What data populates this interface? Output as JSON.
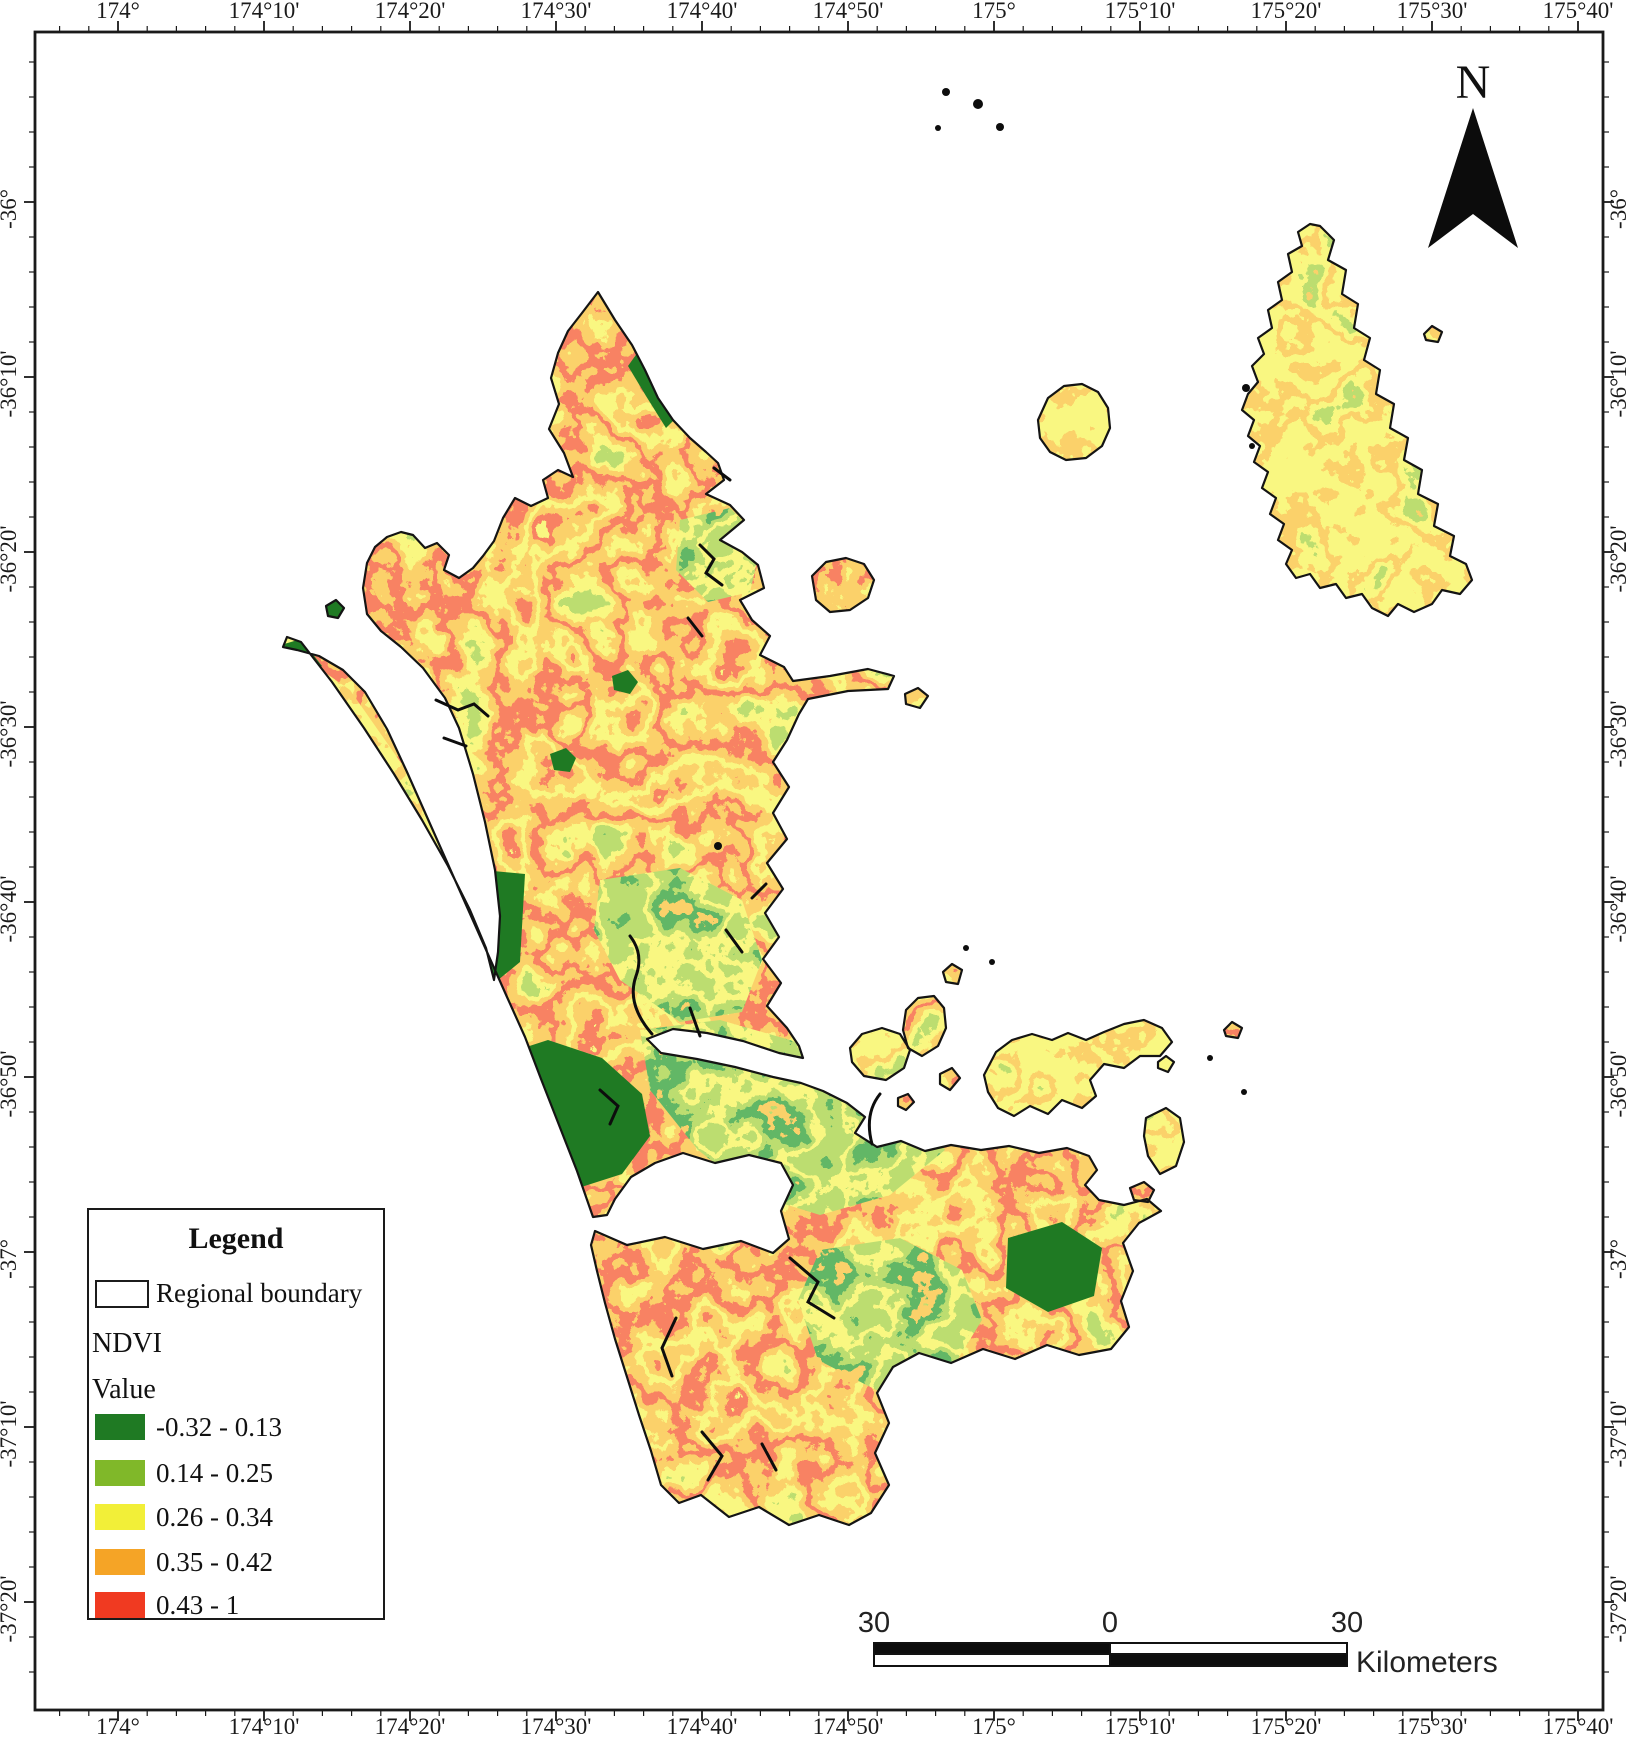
{
  "axes": {
    "lon_labels": [
      "174°",
      "174°10'",
      "174°20'",
      "174°30'",
      "174°40'",
      "174°50'",
      "175°",
      "175°10'",
      "175°20'",
      "175°30'",
      "175°40'"
    ],
    "lat_labels": [
      "-36°",
      "-36°10'",
      "-36°20'",
      "-36°30'",
      "-36°40'",
      "-36°50'",
      "-37°",
      "-37°10'",
      "-37°20'"
    ]
  },
  "north_arrow": {
    "label": "N"
  },
  "scale_bar": {
    "left_label": "30",
    "mid_label": "0",
    "right_label": "30",
    "unit": "Kilometers"
  },
  "legend": {
    "title": "Legend",
    "boundary_item": {
      "label": "Regional boundary"
    },
    "layer_name": "NDVI",
    "value_heading": "Value",
    "classes": [
      {
        "label": "-0.32 - 0.13",
        "color": "#1f7a23"
      },
      {
        "label": "0.14 - 0.25",
        "color": "#80b829"
      },
      {
        "label": "0.26 - 0.34",
        "color": "#f2ef38"
      },
      {
        "label": "0.35 - 0.42",
        "color": "#f5a426"
      },
      {
        "label": "0.43 - 1",
        "color": "#f03a21"
      }
    ]
  }
}
